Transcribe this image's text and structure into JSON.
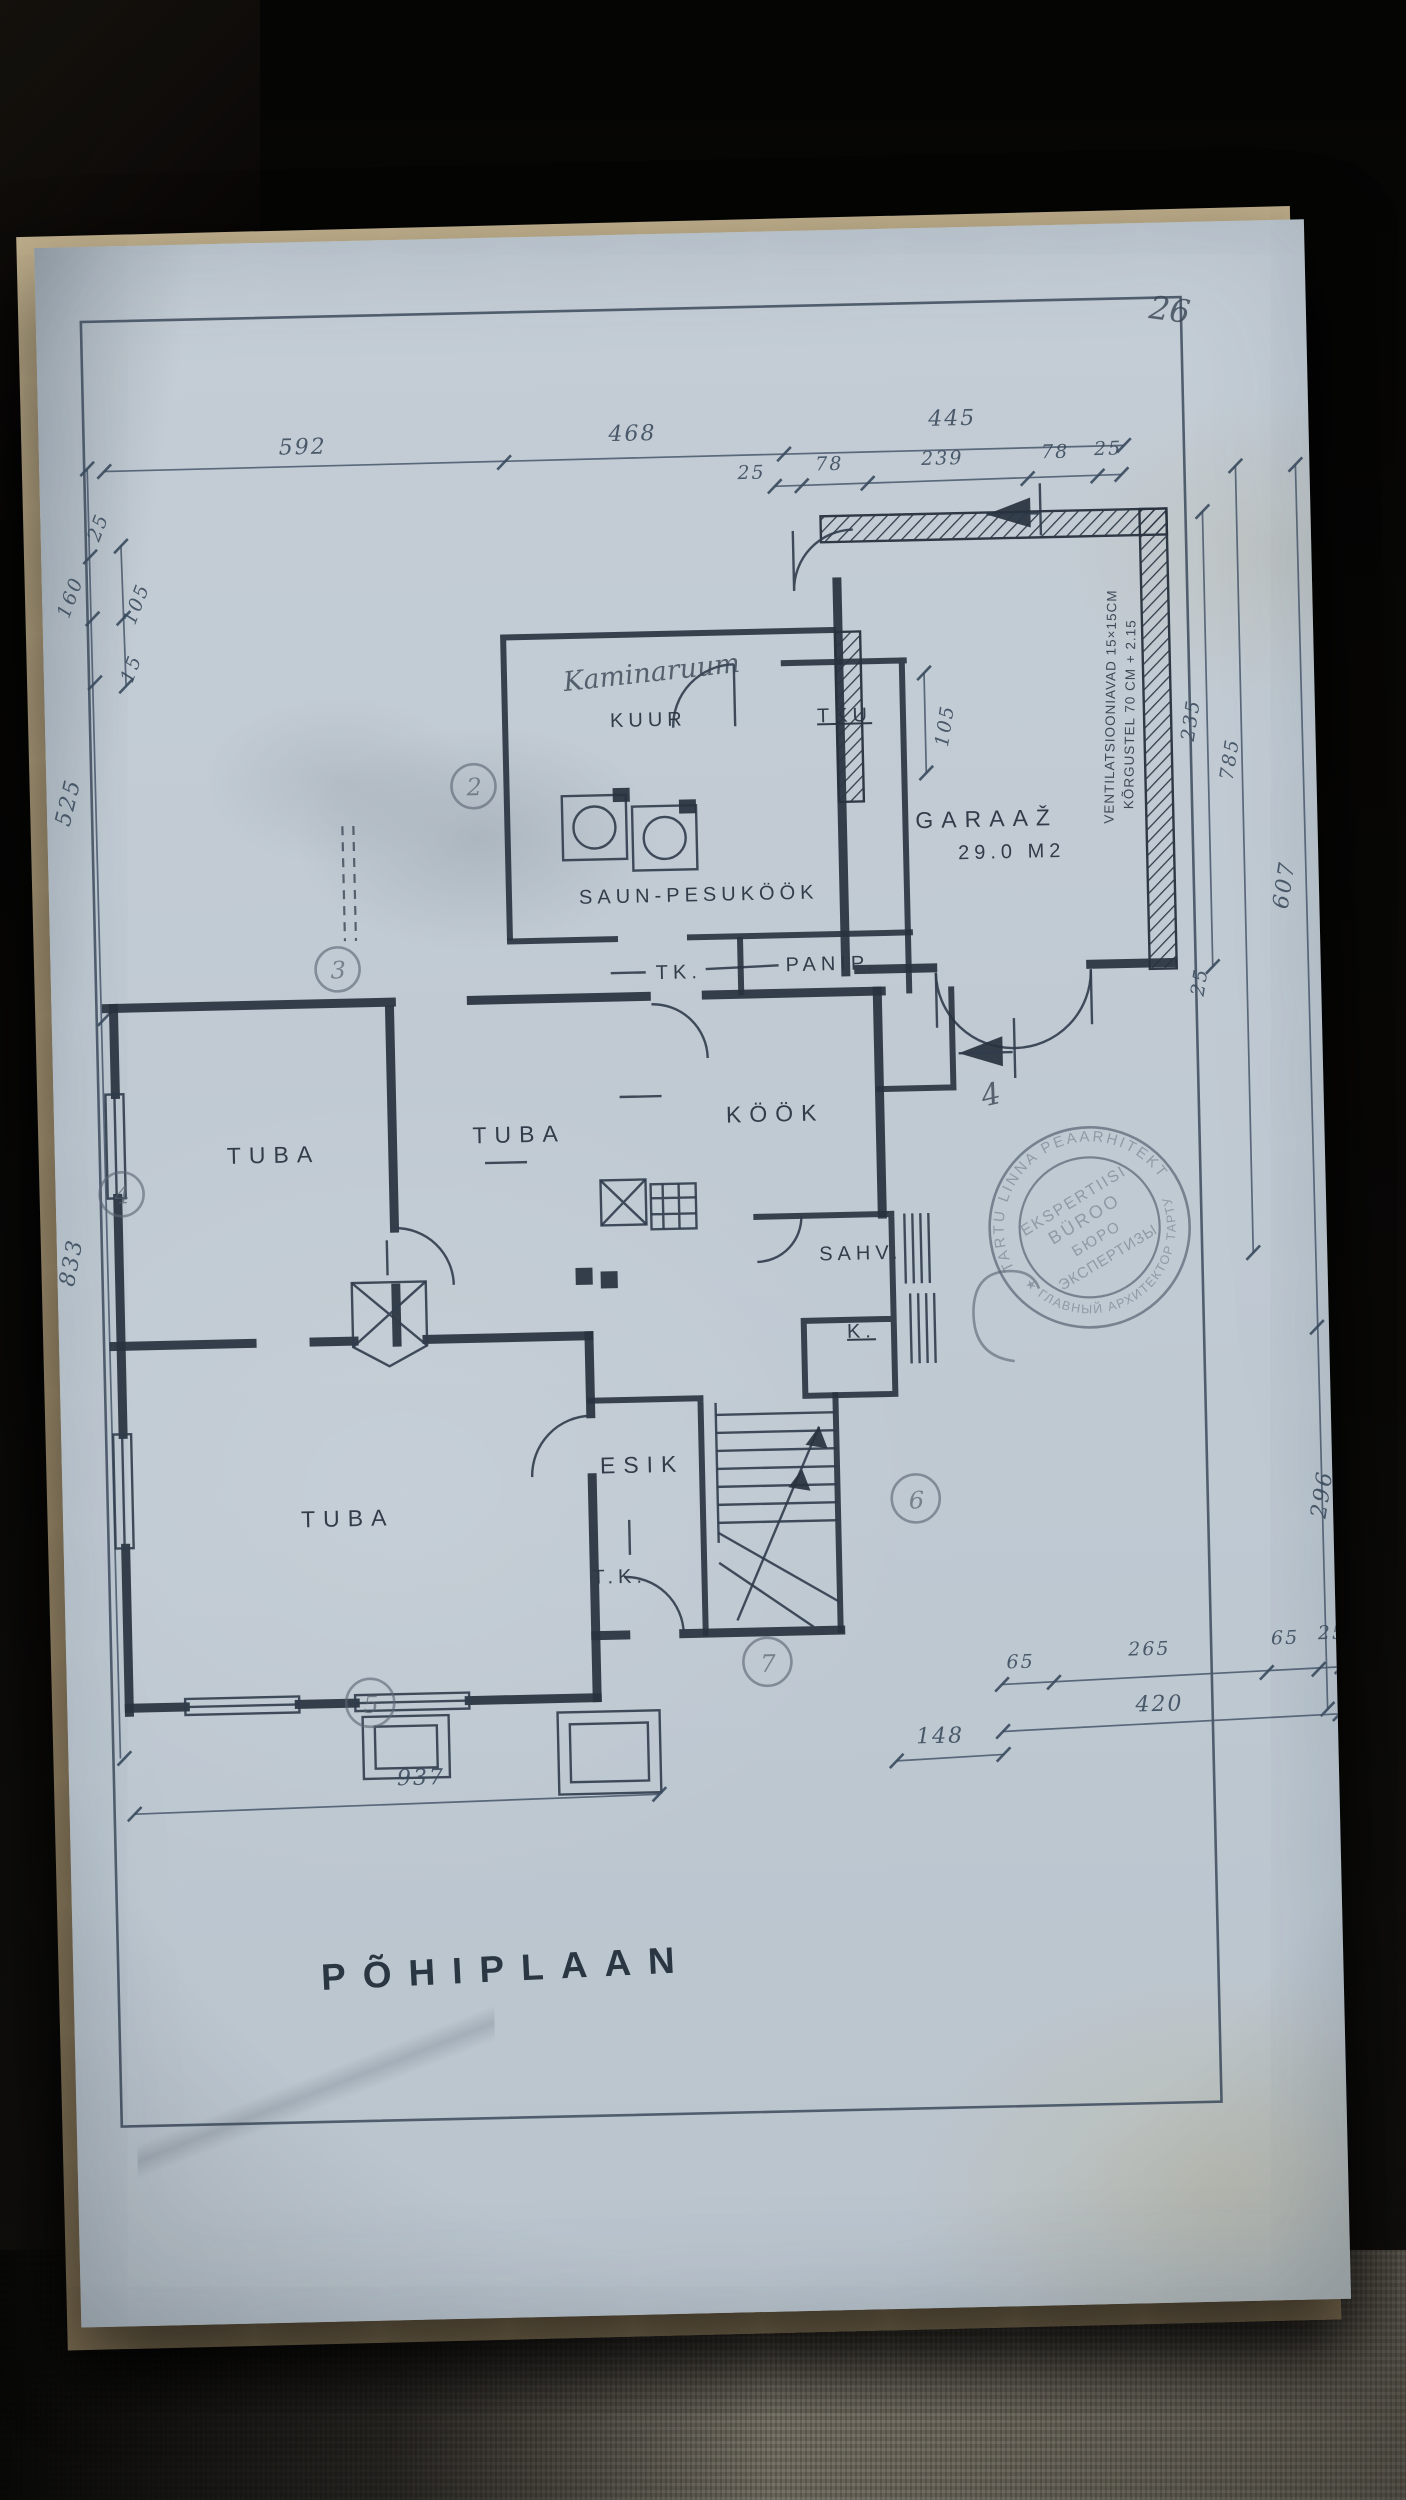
{
  "page_number": "26",
  "title": "PÕHIPLAAN",
  "section_mark": "4",
  "rooms": {
    "kaminaruum": "Kaminaruum",
    "kuur": "KUUR",
    "tku": "TKU",
    "saun": "SAUN-PESUKÖÖK",
    "tk": "TK.",
    "panip": "PANIP.",
    "tuba1": "TUBA",
    "tuba2": "TUBA",
    "kook": "KÖÖK",
    "sahv": "SAHV.",
    "k": "K.",
    "esik": "ESIK",
    "tk2": "T.K.",
    "tuba3": "TUBA",
    "garaaz": "GARAAŽ",
    "garaaz_area": "29.0 M2"
  },
  "notes": {
    "vent1": "VENTILATSIOONIAVAD 15×15CM",
    "vent2": "KÕRGUSTEL 70 CM + 2.15"
  },
  "dims": {
    "top": [
      "592",
      "468",
      "445"
    ],
    "top_sub": [
      "25",
      "78",
      "239",
      "78",
      "25"
    ],
    "left_small": [
      "25",
      "160",
      "105",
      "15"
    ],
    "left_tall": [
      "525",
      "833"
    ],
    "right_garage": [
      "235",
      "785",
      "25"
    ],
    "right_tall": [
      "607",
      "296"
    ],
    "tku": "105",
    "bottom_main": "937",
    "bottom_right_upper": [
      "65",
      "265",
      "65",
      "25"
    ],
    "bottom_right_mid": "420",
    "bottom_right_left": "148"
  },
  "axis_bubbles": [
    "2",
    "3",
    "4",
    "5",
    "6",
    "7"
  ],
  "stamp": {
    "ring_top": "TARTU LINNA PEAARHITEKT",
    "ring_bottom": "★ ГЛАВНЫЙ АРХИТЕКТОР ТАРТУ",
    "inner1": "EKSPERTIISI",
    "inner2": "BÜROO",
    "inner3": "БЮРО",
    "inner4": "ЭКСПЕРТИЗЫ"
  },
  "colors": {
    "paper": "#c3ccd4",
    "ink": "#2c3644",
    "pencil": "#56616f",
    "background": "#070606",
    "fabric": "#8e897c"
  }
}
